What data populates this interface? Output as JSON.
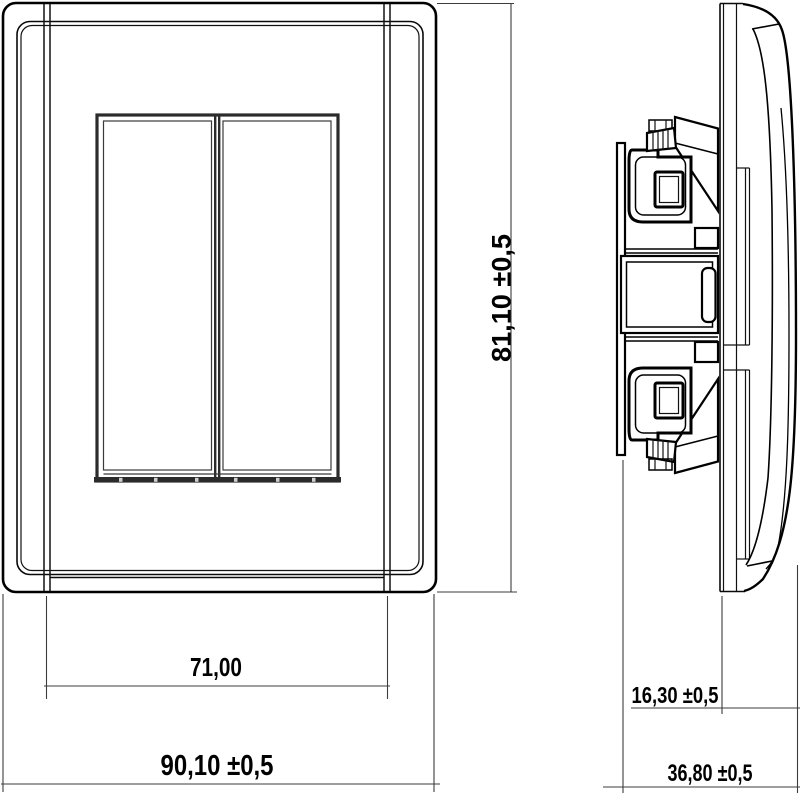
{
  "diagram": {
    "kind": "technical-drawing-wall-switch",
    "background_color": "#ffffff",
    "line_color": "#000000",
    "dim_line_color": "#3c3c3c",
    "dimensions": {
      "inner_width": "71,00",
      "overall_width": "90,10 ±0,5",
      "overall_height": "81,10 ±0,5",
      "bezel_depth": "16,30 ±0,5",
      "overall_depth": "36,80 ±0,5"
    }
  }
}
